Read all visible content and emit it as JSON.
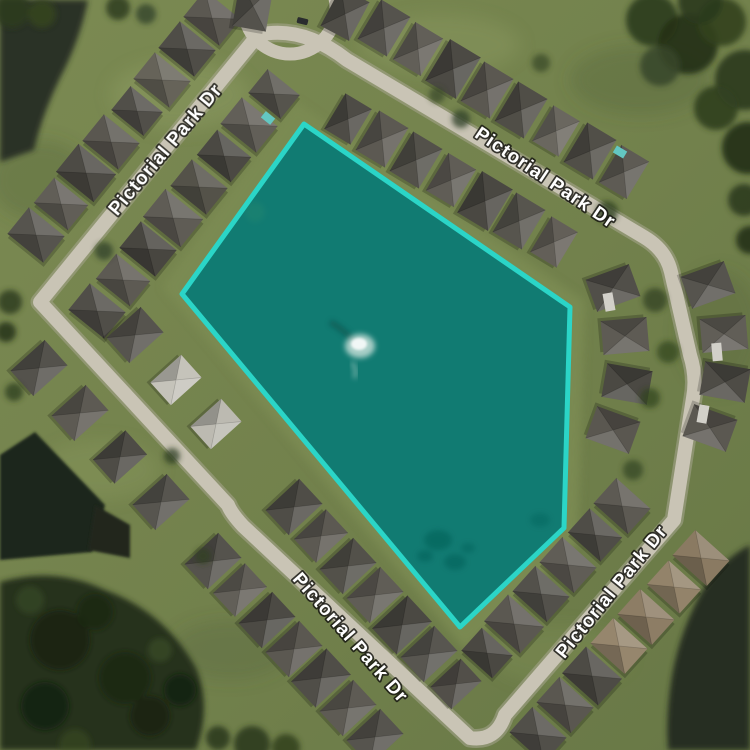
{
  "map": {
    "view": "satellite",
    "street_labels": [
      {
        "text": "Pictorial Park Dr"
      },
      {
        "text": "Pictorial Park Dr"
      },
      {
        "text": "Pictorial Park Dr"
      },
      {
        "text": "Pictorial Park Dr"
      }
    ],
    "parcel_highlight": {
      "points": "304,124 570,307 564,528 460,627 182,294",
      "fill_color": "#10978d",
      "fill_opacity": "0.72",
      "stroke_color": "#2bd5c7",
      "stroke_width": "5"
    },
    "lake_feature": "fountain"
  }
}
